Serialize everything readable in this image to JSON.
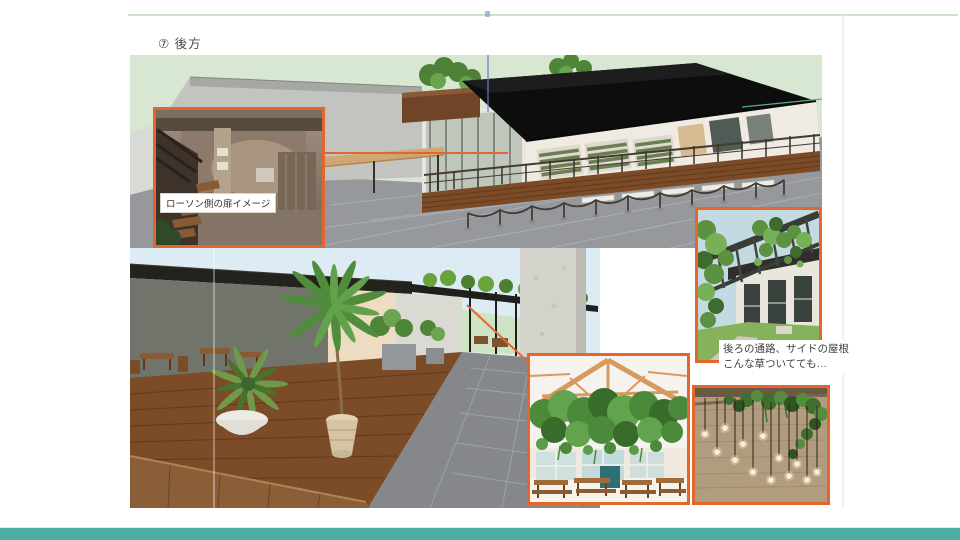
{
  "slide": {
    "title": "⑦ 後方",
    "accent_colors": {
      "callout_border": "#E2672F",
      "footer_bar": "#4BB0A1",
      "top_rule": "#CDE3C9"
    }
  },
  "callouts": {
    "lawson_label": "ローソン側の扉イメージ",
    "pergola_note": {
      "line1": "後ろの通路、サイドの屋根",
      "line2": "こんな草ついてても…"
    }
  }
}
